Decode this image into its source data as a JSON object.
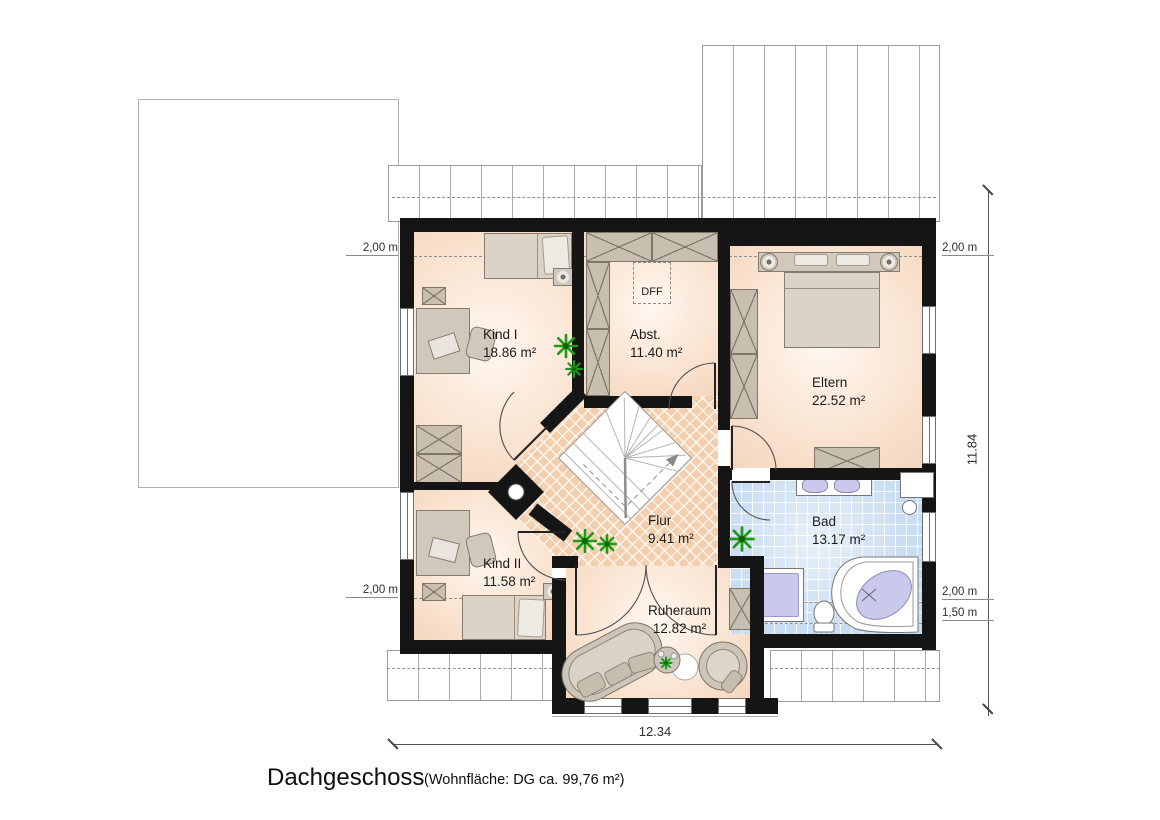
{
  "title": {
    "main": "Dachgeschoss",
    "sub": "(Wohnfläche: DG  ca. 99,76 m²)"
  },
  "rooms": {
    "kind1": {
      "name": "Kind I",
      "area": "18.86 m²"
    },
    "abst": {
      "name": "Abst.",
      "area": "11.40 m²"
    },
    "eltern": {
      "name": "Eltern",
      "area": "22.52 m²"
    },
    "bad": {
      "name": "Bad",
      "area": "13.17 m²"
    },
    "kind2": {
      "name": "Kind II",
      "area": "11.58 m²"
    },
    "flur": {
      "name": "Flur",
      "area": "9.41 m²"
    },
    "ruheraum": {
      "name": "Ruheraum",
      "area": "12.82 m²"
    }
  },
  "annotations": {
    "roof_window": "DFF"
  },
  "dimensions": {
    "left_upper": "2,00 m",
    "left_lower": "2,00 m",
    "right_upper": "2,00 m",
    "right_mid": "2,00 m",
    "right_lower": "1,50 m",
    "total_height": "11.84",
    "total_width": "12.34"
  },
  "colors": {
    "wall": "#151515",
    "room_fill": "#f8dcc8",
    "hall_fill": "#f4cfae",
    "bath_tile": "#c9ddf1",
    "furniture": "#d0c8bb",
    "fixture": "#c9c9ec",
    "plant": "#1d9a17"
  }
}
